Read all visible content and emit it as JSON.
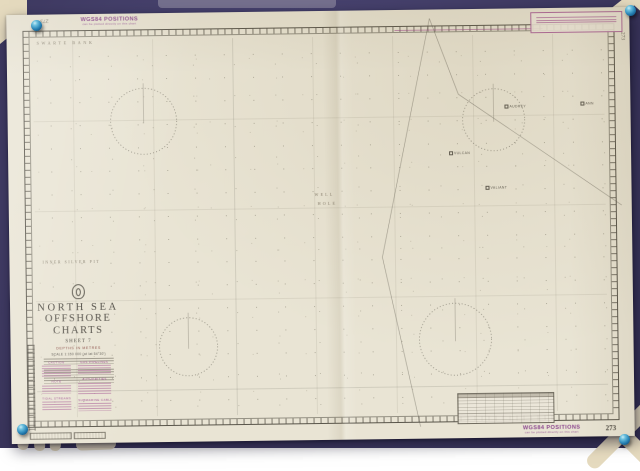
{
  "chart": {
    "number": "273",
    "stamp": {
      "title": "WGS84 POSITIONS",
      "subtitle": "can be plotted directly on this chart"
    },
    "margin": {
      "top_left_number": "273",
      "right_number": "273",
      "bottom_right_number": "273"
    },
    "title_block": {
      "region": "NORTH SEA",
      "series": "OFFSHORE CHARTS",
      "sheet": "SHEET 7",
      "depths_note": "DEPTHS IN METRES",
      "scale_note": "SCALE 1:150 000 (at lat 54°30')"
    },
    "place_labels": {
      "bank_top_left": "SWARTE BANK",
      "hole_center_top": "WELL",
      "hole_center_bottom": "HOLE",
      "pit_left": "INNER SILVER PIT"
    },
    "field_labels": [
      "AUDREY",
      "ANN",
      "VULCAN",
      "VALIANT"
    ],
    "note_headings": [
      "CAUTION",
      "NOTE",
      "TIDAL STREAMS",
      "GAS PIPELINES",
      "AUTHORITIES",
      "SUBMARINE CABLES"
    ]
  }
}
